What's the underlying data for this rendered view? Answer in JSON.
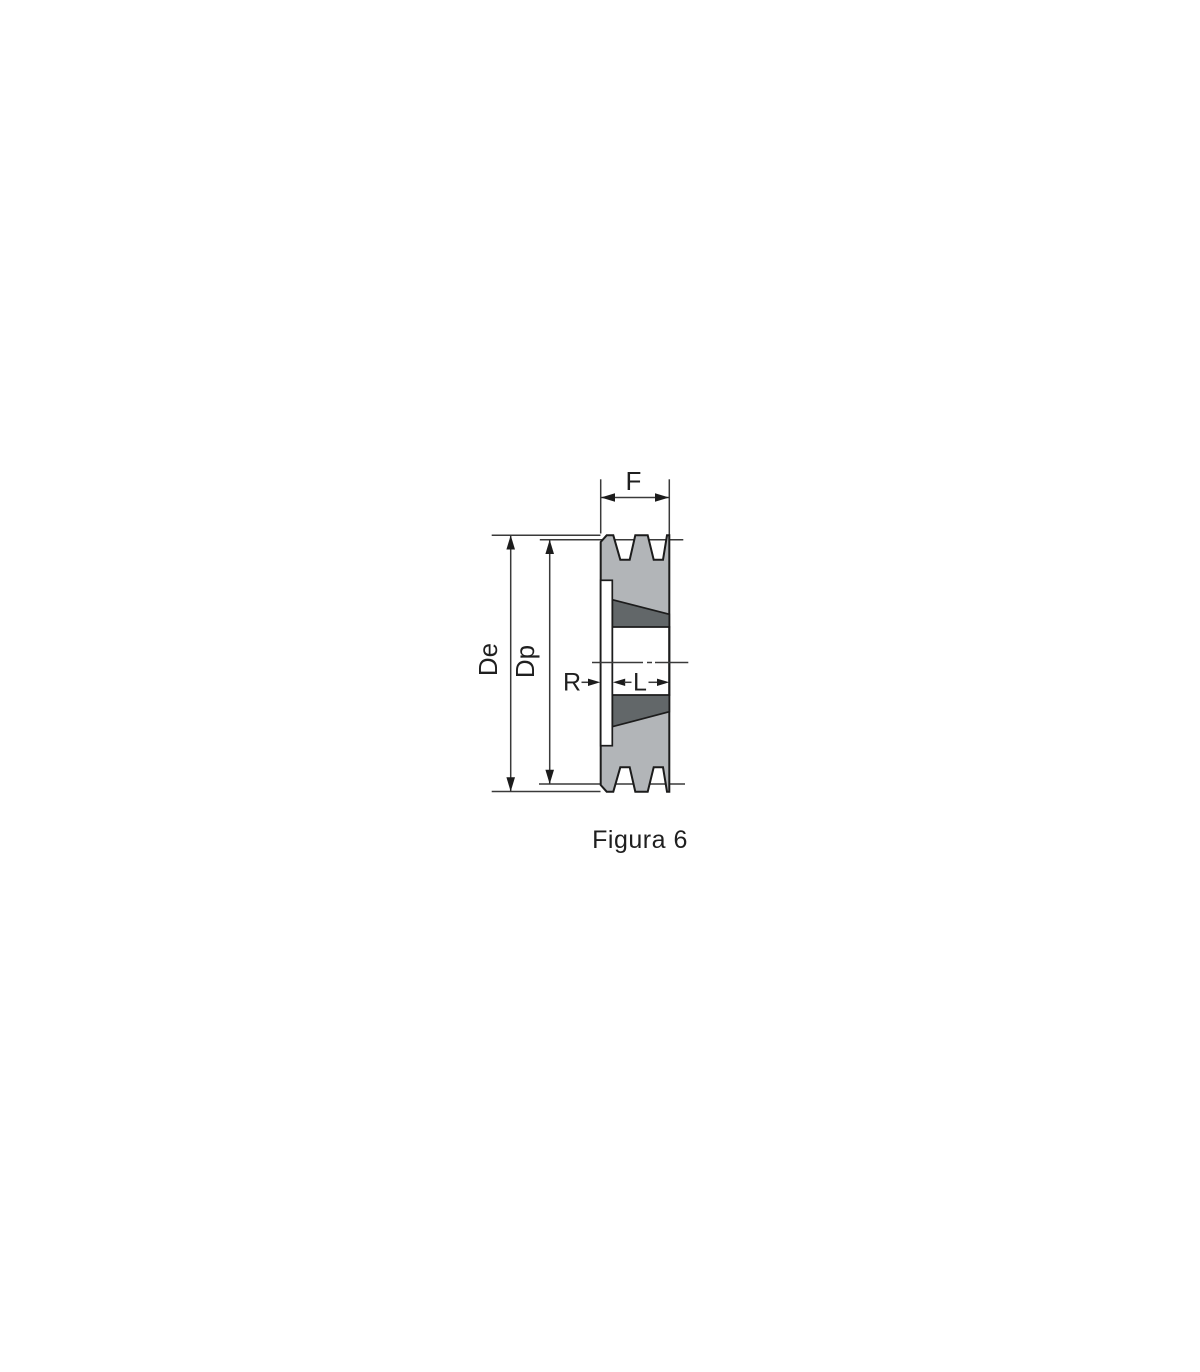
{
  "figure": {
    "caption": "Figura 6",
    "labels": {
      "face_width": "F",
      "outer_diameter": "De",
      "pitch_diameter": "Dp",
      "recess_width": "R",
      "bushing_length": "L"
    }
  },
  "colors": {
    "background": "#ffffff",
    "body_light": "#b2b5b8",
    "taper_dark": "#626769",
    "outline": "#1c1c1c",
    "dimension_line": "#3a3a3a",
    "text": "#1f1f1f"
  }
}
